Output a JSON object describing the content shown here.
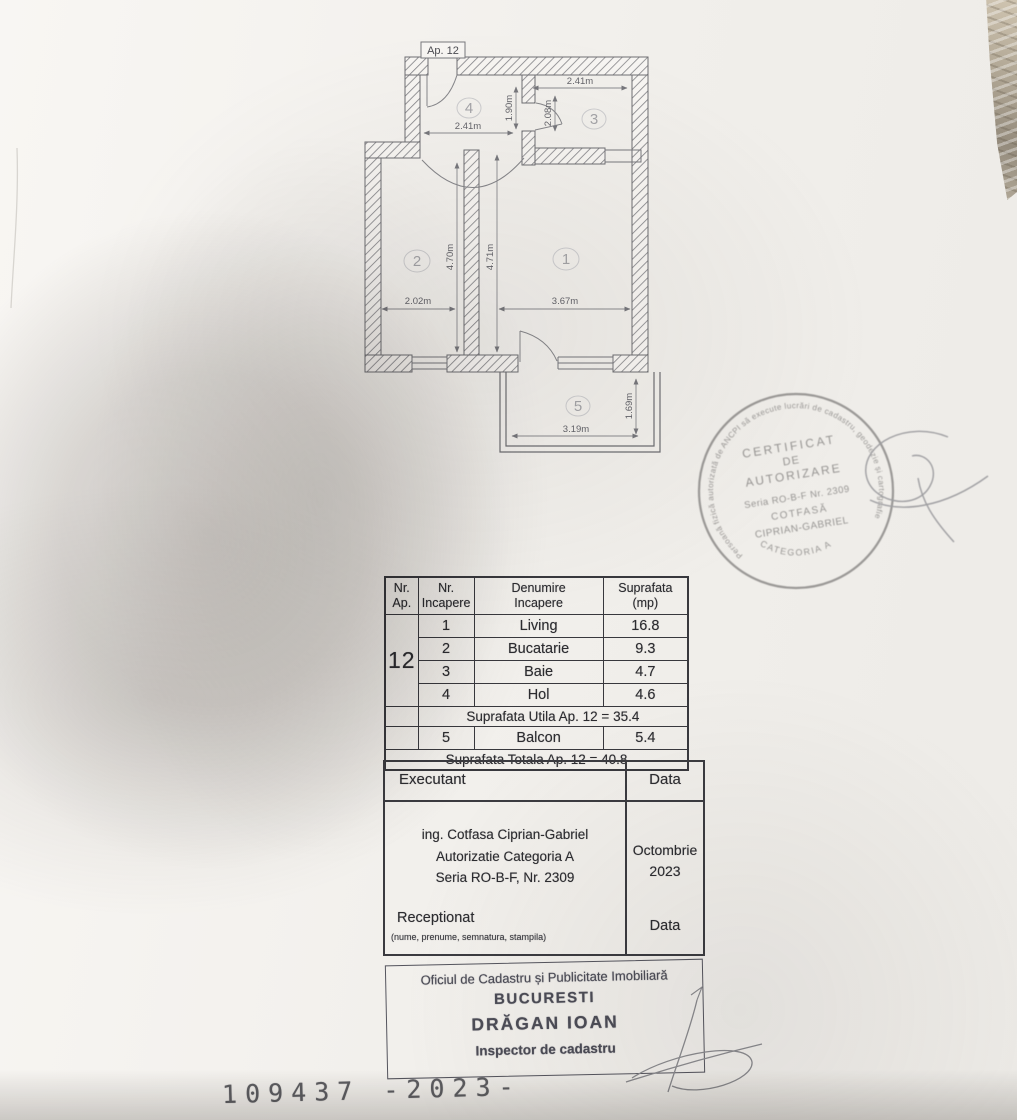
{
  "plan": {
    "ap_label": "Ap. 12",
    "rooms": {
      "r1": {
        "number": "1",
        "width": "3.67m",
        "height": "4.71m"
      },
      "r2": {
        "number": "2",
        "width": "2.02m",
        "height": "4.70m"
      },
      "r3": {
        "number": "3",
        "width": "2.41m",
        "height": "2.08m"
      },
      "r4": {
        "number": "4",
        "width": "2.41m",
        "height": "1.90m"
      },
      "r5": {
        "number": "5",
        "width": "3.19m",
        "height": "1.69m"
      }
    }
  },
  "round_stamp": {
    "ring_text": "Persoană fizică autorizată de ANCPI să execute lucrări de cadastru, geodezie și cartografie",
    "category": "CATEGORIA A",
    "line1": "CERTIFICAT",
    "line2": "DE",
    "line3": "AUTORIZARE",
    "line4": "Seria RO-B-F Nr. 2309",
    "line5": "COTFASĂ",
    "line6": "CIPRIAN-GABRIEL"
  },
  "table": {
    "headers": {
      "col1a": "Nr.",
      "col1b": "Ap.",
      "col2a": "Nr.",
      "col2b": "Incapere",
      "col3a": "Denumire",
      "col3b": "Incapere",
      "col4a": "Suprafata",
      "col4b": "(mp)"
    },
    "apartment_number": "12",
    "rows": [
      {
        "nr": "1",
        "name": "Living",
        "area": "16.8"
      },
      {
        "nr": "2",
        "name": "Bucatarie",
        "area": "9.3"
      },
      {
        "nr": "3",
        "name": "Baie",
        "area": "4.7"
      },
      {
        "nr": "4",
        "name": "Hol",
        "area": "4.6"
      }
    ],
    "utila": "Suprafata Utila Ap. 12 =  35.4",
    "balcon": {
      "nr": "5",
      "name": "Balcon",
      "area": "5.4"
    },
    "totala": "Suprafata Totala Ap. 12 =  40.8"
  },
  "executant": {
    "header": "Executant",
    "date_header": "Data",
    "line1": "ing. Cotfasa Ciprian-Gabriel",
    "line2": "Autorizatie Categoria A",
    "line3": "Seria RO-B-F, Nr. 2309",
    "month": "Octombrie",
    "year": "2023",
    "receptionat": "Receptionat",
    "receptionat_note": "(nume, prenume, semnatura, stampila)",
    "date_label2": "Data"
  },
  "office_stamp": {
    "lines": [
      "Oficiul de Cadastru și Publicitate Imobiliară",
      "BUCURESTI",
      "DRĂGAN IOAN",
      "Inspector de cadastru"
    ]
  },
  "footer": {
    "number": "109437 -2023-"
  },
  "colors": {
    "ink": "#2c2c30",
    "plan_line": "#6e6e72",
    "round_stamp_ink": "#8f8d8b",
    "office_stamp_ink": "#4c4c56",
    "paper": "#f1efeb"
  }
}
